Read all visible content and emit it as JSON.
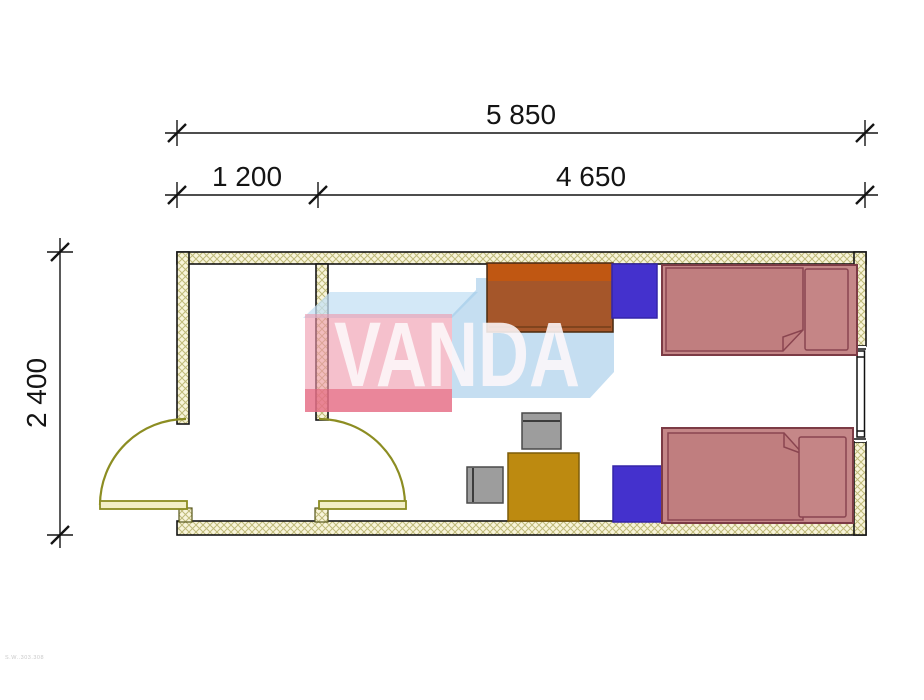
{
  "drawing": {
    "type": "floor-plan",
    "brand_watermark": "VANDA",
    "sheet_code": "S.W..303.308"
  },
  "dimensions": {
    "overall_width": "5 850",
    "entry_width": "1 200",
    "room_width": "4 650",
    "overall_depth": "2 400"
  },
  "colors": {
    "wall_fill": "#f8f4da",
    "wall_hatch": "#bfba79",
    "wall_stroke": "#151515",
    "door_olive": "#8c8d22",
    "bed_fill": "#c58788",
    "blanket_fill": "#c07e7f",
    "pillow_fill": "#c58586",
    "bed_stroke": "#7c3b45",
    "wardrobe_top": "#c05712",
    "wardrobe_body": "#a5562a",
    "nightstand_fill": "#4431cd",
    "table_fill": "#bd8a10",
    "chair_fill": "#9d9d9d",
    "dim_color": "#141414",
    "wm_pink": "rgba(238,150,170,0.60)",
    "wm_red": "rgba(228,98,122,0.62)",
    "wm_blue": "rgba(150,195,230,0.55)",
    "wm_band": "rgba(196,224,244,0.75)",
    "wm_letters": "rgba(253,247,249,0.88)"
  }
}
